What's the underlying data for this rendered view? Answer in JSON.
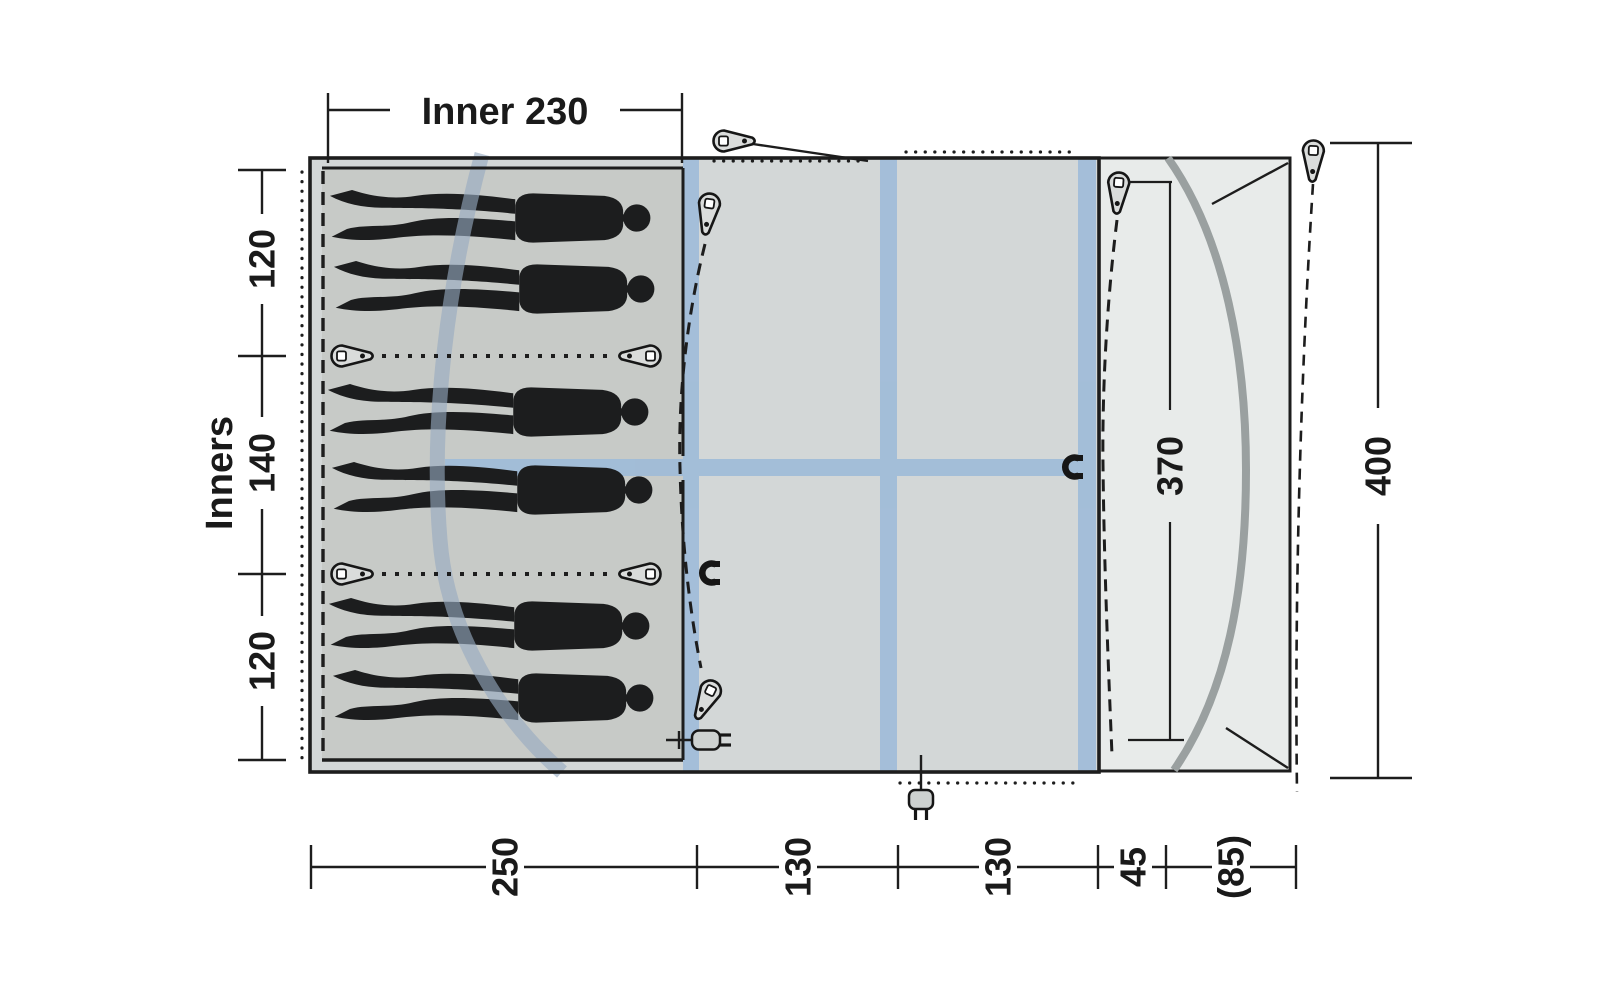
{
  "diagram": {
    "type": "tent-floorplan",
    "top_dimension": {
      "label": "Inner 230"
    },
    "left_axis": {
      "title": "Inners",
      "segments": [
        "120",
        "140",
        "120"
      ]
    },
    "bottom_axis": {
      "segments": [
        "250",
        "130",
        "130",
        "45",
        "(85)"
      ]
    },
    "right_axis": {
      "total": "400"
    },
    "canopy": {
      "depth_label": "370"
    },
    "sleepers": {
      "count": 6
    },
    "icons": {
      "tent_peg_count": 9,
      "magnet_clip_count": 2,
      "power_plug_count": 2,
      "guy_line_count": 2
    },
    "colors": {
      "body_fill": "#d3d7d7",
      "inner_fill": "#c7cac7",
      "canopy_fill": "#e8ebea",
      "tape_blue": "#9dbbd9",
      "air_tube_blue": "#96aec6",
      "pole_gray": "#9aa0a0",
      "line_black": "#1d1d1d"
    }
  }
}
